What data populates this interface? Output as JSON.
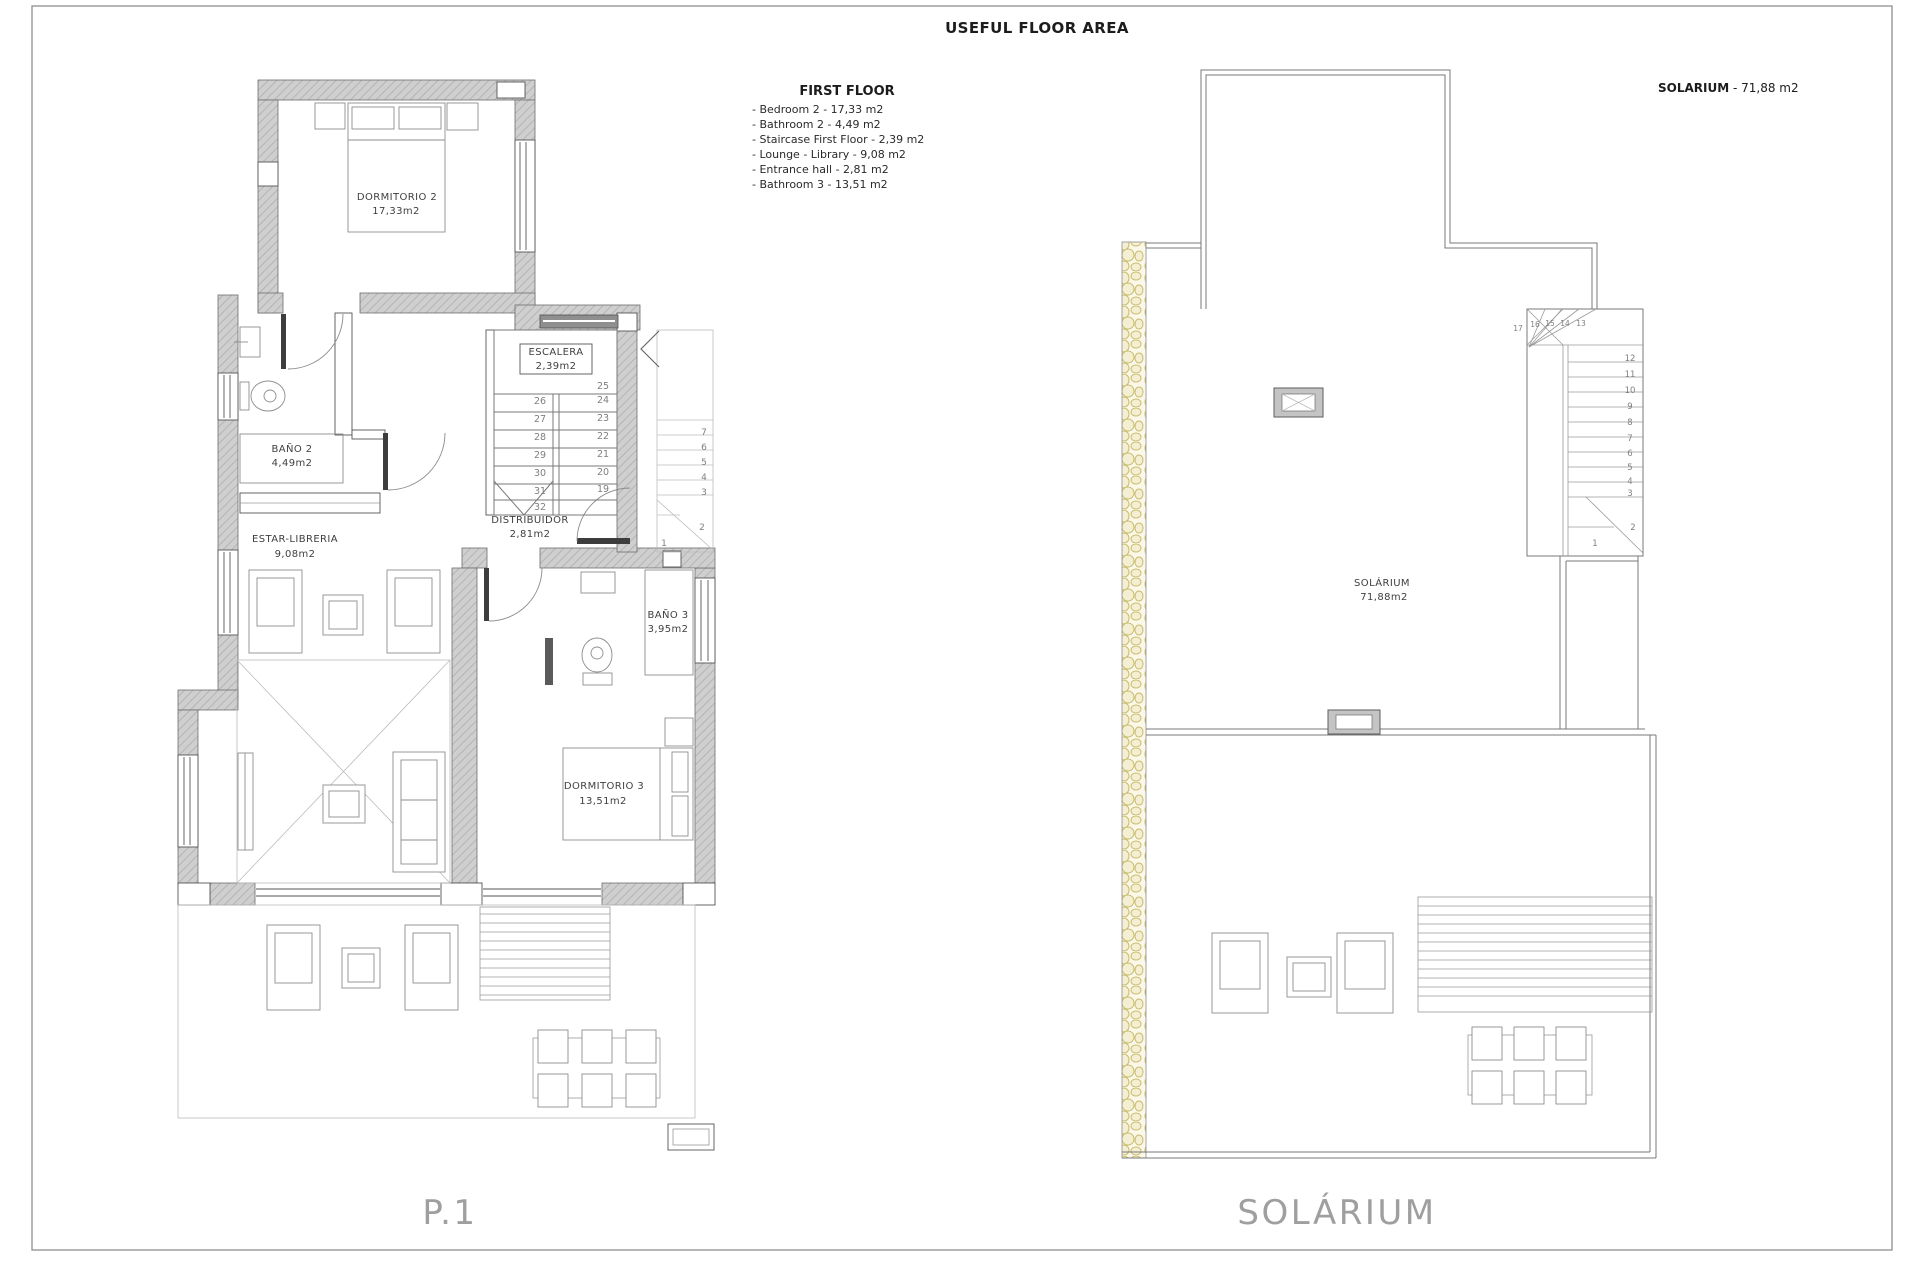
{
  "header": {
    "title": "USEFUL FLOOR AREA",
    "legend_title": "FIRST FLOOR",
    "legend_items": [
      "- Bedroom 2 - 17,33 m2",
      "- Bathroom 2 - 4,49 m2",
      "- Staircase First Floor - 2,39 m2",
      "- Lounge - Library - 9,08 m2",
      "- Entrance hall - 2,81 m2",
      "- Bathroom 3 - 13,51 m2"
    ],
    "solarium_title": "SOLARIUM",
    "solarium_area": " - 71,88 m2"
  },
  "left_plan": {
    "caption": "P.1",
    "rooms": {
      "dormitorio2": {
        "name": "DORMITORIO 2",
        "area": "17,33m2"
      },
      "bano2": {
        "name": "BAÑO 2",
        "area": "4,49m2"
      },
      "escalera": {
        "name": "ESCALERA",
        "area": "2,39m2"
      },
      "distribuidor": {
        "name": "DISTRIBUIDOR",
        "area": "2,81m2"
      },
      "estar": {
        "name": "ESTAR-LIBRERIA",
        "area": "9,08m2"
      },
      "bano3": {
        "name": "BAÑO 3",
        "area": "3,95m2"
      },
      "dormitorio3": {
        "name": "DORMITORIO 3",
        "area": "13,51m2"
      }
    },
    "stairs": {
      "left_col": [
        "26",
        "27",
        "28",
        "29",
        "30",
        "31",
        "32"
      ],
      "right_col": [
        "25",
        "24",
        "23",
        "22",
        "21",
        "20",
        "19"
      ],
      "ghost_col": [
        "7",
        "6",
        "5",
        "4",
        "3",
        "2",
        "1"
      ]
    }
  },
  "right_plan": {
    "caption": "SOLÁRIUM",
    "room": {
      "name": "SOLÁRIUM",
      "area": "71,88m2"
    },
    "stairs": {
      "winders_top": [
        "17",
        "16",
        "15",
        "14",
        "13"
      ],
      "run": [
        "12",
        "11",
        "10",
        "9",
        "8",
        "7",
        "6",
        "5",
        "4",
        "3"
      ],
      "winders_bottom": [
        "2",
        "1"
      ]
    }
  },
  "colors": {
    "wall_gray": "#cdcdcd",
    "pebble_band": "#cbbd6e",
    "line": "#777777"
  }
}
